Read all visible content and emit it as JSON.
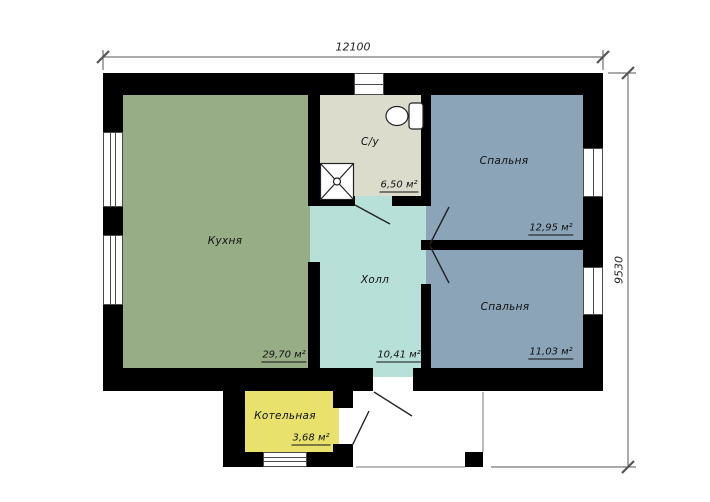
{
  "plan": {
    "type": "floor-plan",
    "dimensions": {
      "width_label": "12100",
      "height_label": "9530"
    },
    "rooms": [
      {
        "id": "kitchen",
        "name": "Кухня",
        "area": "29,70 м²",
        "color": "#96ad85"
      },
      {
        "id": "bathroom",
        "name": "С/у",
        "area": "6,50 м²",
        "color": "#dcdccd"
      },
      {
        "id": "bedroom1",
        "name": "Спальня",
        "area": "12,95 м²",
        "color": "#8ba4b8"
      },
      {
        "id": "bedroom2",
        "name": "Спальня",
        "area": "11,03 м²",
        "color": "#8ba4b8"
      },
      {
        "id": "hall",
        "name": "Холл",
        "area": "10,41 м²",
        "color": "#b7e1d8"
      },
      {
        "id": "boiler",
        "name": "Котельная",
        "area": "3,68 м²",
        "color": "#e8e26c"
      }
    ],
    "fixtures": [
      "shower-tray",
      "toilet"
    ],
    "colors": {
      "wall": "#000000",
      "dimension_line": "#555555",
      "background": "#ffffff"
    }
  }
}
